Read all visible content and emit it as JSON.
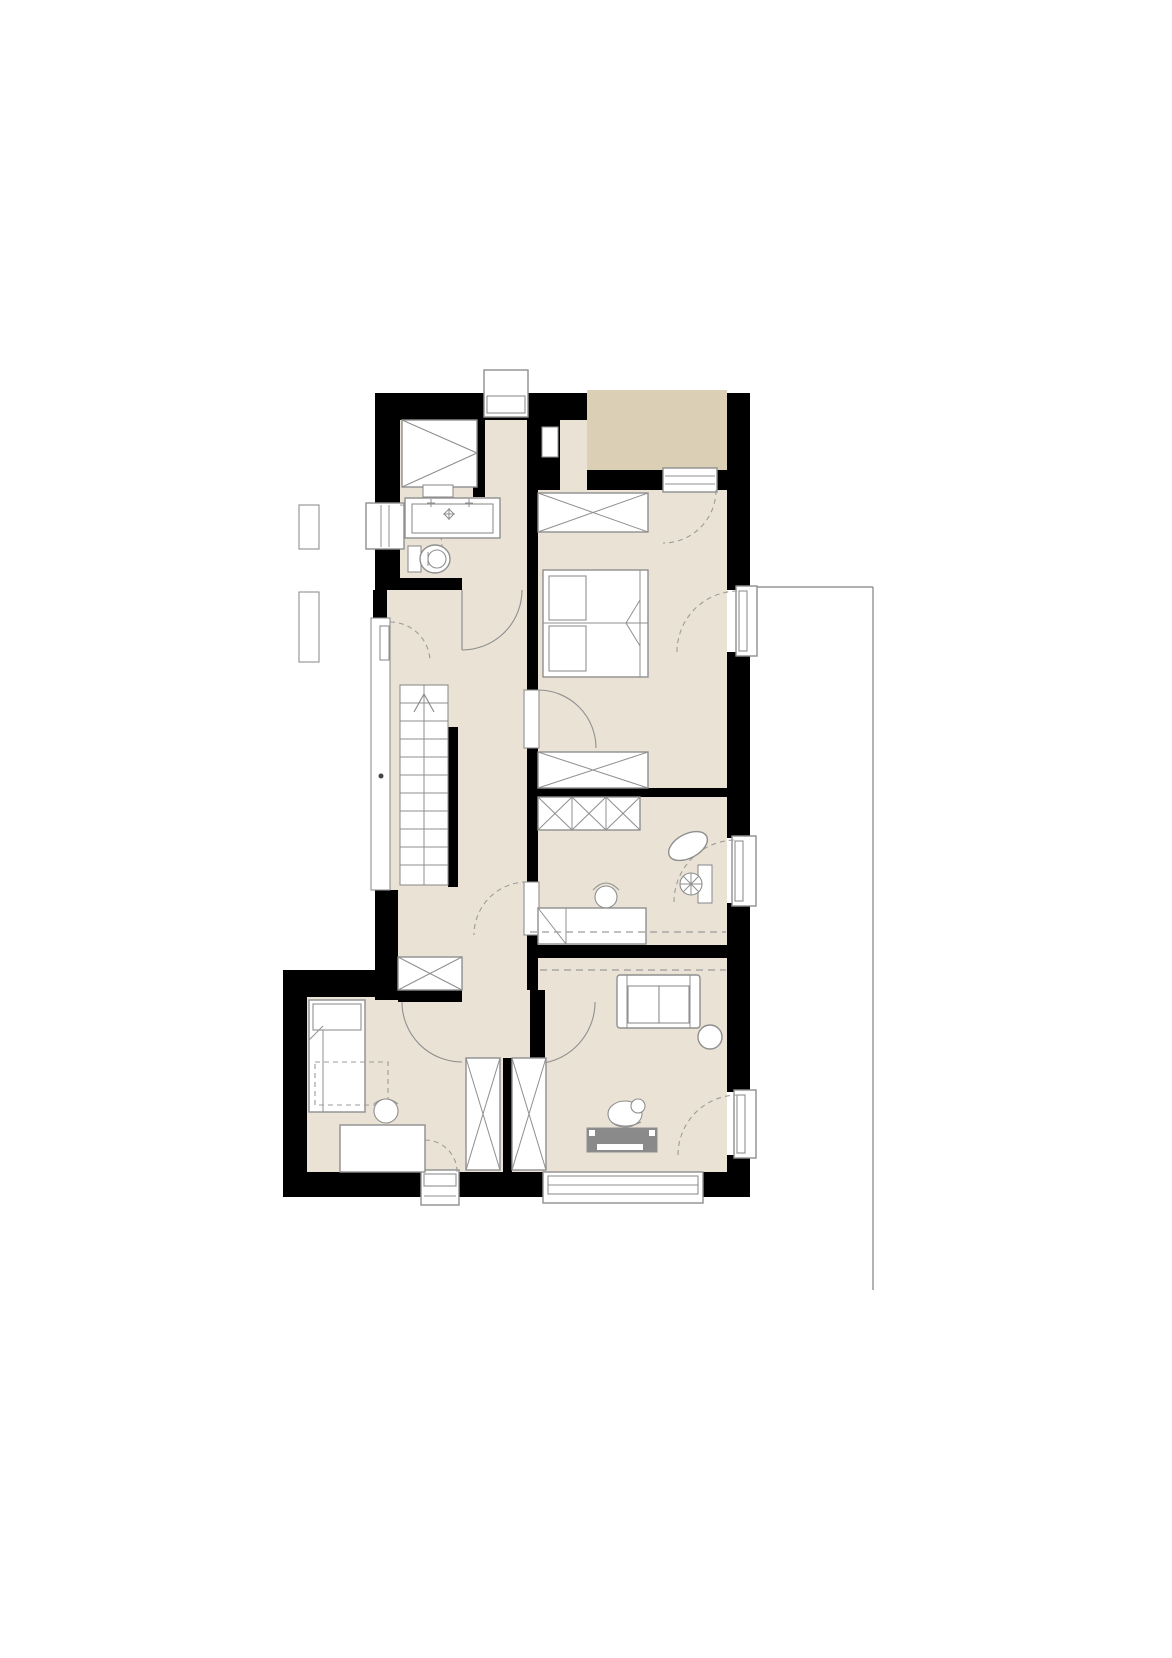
{
  "meta": {
    "document_type": "architectural-floor-plan",
    "view": "top-down",
    "text_labels": []
  },
  "colors": {
    "background": "#ffffff",
    "wall": "#000000",
    "floor": "#eae3d5",
    "balcony": "#dbcfb5",
    "outline": "#8f8f8f",
    "dashed": "#9c9c9c",
    "tv_board": "#8a8a8a",
    "terrace_line": "#808080"
  },
  "elements": {
    "structure": [
      "exterior-walls",
      "interior-walls",
      "balcony",
      "terrace-outline",
      "chimney",
      "wall-niche",
      "stair-window-strip",
      "window-sill-boxes"
    ],
    "openings": [
      "balcony-door",
      "terrace-door-bedroom",
      "terrace-door-study",
      "terrace-door-living",
      "bathroom-door",
      "bedroom-door",
      "study-door",
      "kids-room-double-swing",
      "left-casement-window",
      "bottom-small-window",
      "bottom-large-window"
    ],
    "furniture": [
      "shower",
      "washbasin-vanity",
      "toilet",
      "staircase-up",
      "sliding-wardrobe",
      "double-bed",
      "bedroom-dresser",
      "sideboard",
      "study-desk",
      "desk-chair",
      "office-chair",
      "oval-rug",
      "single-bed",
      "kids-desk",
      "kids-chair",
      "tall-wardrobe-left",
      "tall-wardrobe-right",
      "hall-wardrobe",
      "sofa",
      "round-side-table",
      "tv-lowboard",
      "person-figure"
    ]
  }
}
